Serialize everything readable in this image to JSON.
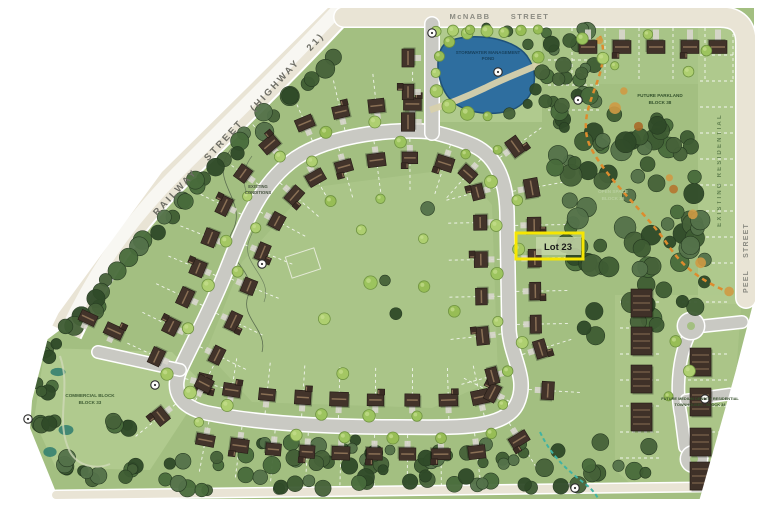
{
  "map": {
    "title": "Subdivision site plan",
    "streets": {
      "mcnabb_word1": "McNABB",
      "mcnabb_word2": "STREET",
      "railway": "RAILWAY STREET (HIGHWAY 21)",
      "peel": "PEEL STREET"
    },
    "areas": {
      "existing_residential": "EXISTING RESIDENTIAL",
      "future_parkland_1": "FUTURE PARKLAND",
      "future_parkland_2": "BLOCK 38",
      "open_space_1": "OPEN SPACE",
      "open_space_2": "BLOCK 36",
      "pond_1": "STORMWATER MANAGEMENT",
      "pond_2": "POND",
      "existing_conditions_1": "EXISTING",
      "existing_conditions_2": "CONDITIONS",
      "commercial_1": "COMMERCIAL BLOCK",
      "commercial_2": "BLOCK 33",
      "townhouse_1": "FUTURE MEDIUM DENSITY RESIDENTIAL",
      "townhouse_2": "TOWNHOUSES - BLOCK 34"
    },
    "highlight": {
      "lot_label": "Lot 23",
      "box_color": "#f6e602"
    },
    "palette": {
      "page_bg": "#ffffff",
      "grass": "#a3bf81",
      "grass_light": "#b0ca8e",
      "road": "#c9c9c3",
      "highway": "#e9e4d5",
      "highway_stripe": "#f8f7f2",
      "pond": "#2e6e9f",
      "pond_edge": "#1f5179",
      "pond_path": "#d8d1ac",
      "house": "#42332a",
      "house_ridge": "#8a7055",
      "driveway": "#d8d6cd",
      "tree_light": "#a4c763",
      "tree_stroke": "#6f9340",
      "forest_dark": "#3e5c33",
      "trail_orange": "#dd8c2e",
      "trail_teal": "#3fb3a2",
      "lot_line": "#ffffff"
    }
  }
}
